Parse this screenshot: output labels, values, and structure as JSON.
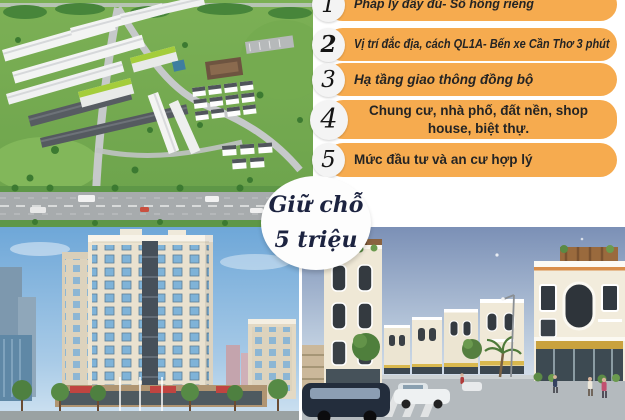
{
  "poster": {
    "features": [
      {
        "number": "1",
        "text": "Pháp lý đầy đủ- Sổ hồng riêng"
      },
      {
        "number": "2",
        "text": "Vị trí đắc địa, cách QL1A- Bến xe Cần Thơ 3 phút"
      },
      {
        "number": "3",
        "text": "Hạ tầng giao thông đồng bộ"
      },
      {
        "number": "4",
        "text": "Chung cư, nhà phố, đất nền, shop house, biệt thự."
      },
      {
        "number": "5",
        "text": "Mức đầu tư và an cư hợp lý"
      }
    ],
    "reservation_badge": {
      "line1": "Giữ chỗ",
      "line2": "5 triệu"
    },
    "colors": {
      "banner": "#F6AB4F",
      "banner_text": "#242424",
      "number_circle": "#F4F4F4",
      "number_text": "#141414",
      "badge_bg": "#FDFDFD",
      "badge_text": "#1C2340"
    },
    "photos": [
      {
        "name": "aerial-masterplan"
      },
      {
        "name": "apartment-tower"
      },
      {
        "name": "shophouse-street"
      }
    ]
  }
}
